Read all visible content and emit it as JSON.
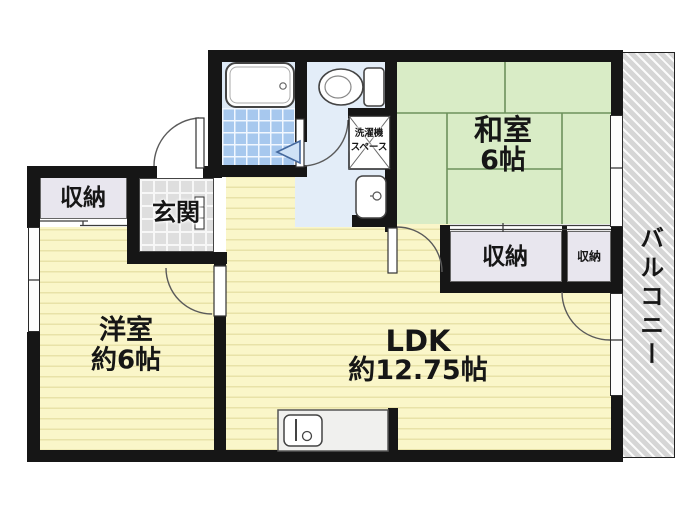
{
  "plan": {
    "type": "japanese-apartment-floor-plan",
    "rooms": {
      "washitsu": {
        "label": "和室",
        "size_label": "6帖"
      },
      "youshitsu": {
        "label": "洋室",
        "size_label": "約6帖"
      },
      "ldk": {
        "label": "LDK",
        "size_label": "約12.75帖"
      },
      "genkan": {
        "label": "玄関"
      },
      "balcony": {
        "label": "バルコニー"
      },
      "storage_entry": {
        "label": "収納"
      },
      "storage_center": {
        "label": "収納"
      },
      "storage_small": {
        "label": "収納"
      },
      "laundry": {
        "label_line1": "洗濯機",
        "label_line2": "スペース"
      }
    },
    "fixtures": [
      "bathtub",
      "toilet",
      "washbasin",
      "washing-machine-space",
      "kitchen-sink-counter",
      "shoe-cabinet",
      "entrance-door",
      "washroom-door",
      "bedroom-door",
      "washitsu-door",
      "storage-door",
      "bath-folding-door",
      "sliding-windows"
    ],
    "colors": {
      "wall": "#161616",
      "wood_floor": "#faf6c9",
      "tatami": "#d9ecc6",
      "tatami_line": "#6d915c",
      "bath_tile": "#a7c8ee",
      "washroom_floor": "#e3edf8",
      "genkan_tile": "#dedede",
      "closet": "#e8e6ee",
      "balcony": "#d6d6d6",
      "folding_door": "#cfe2f6"
    }
  }
}
